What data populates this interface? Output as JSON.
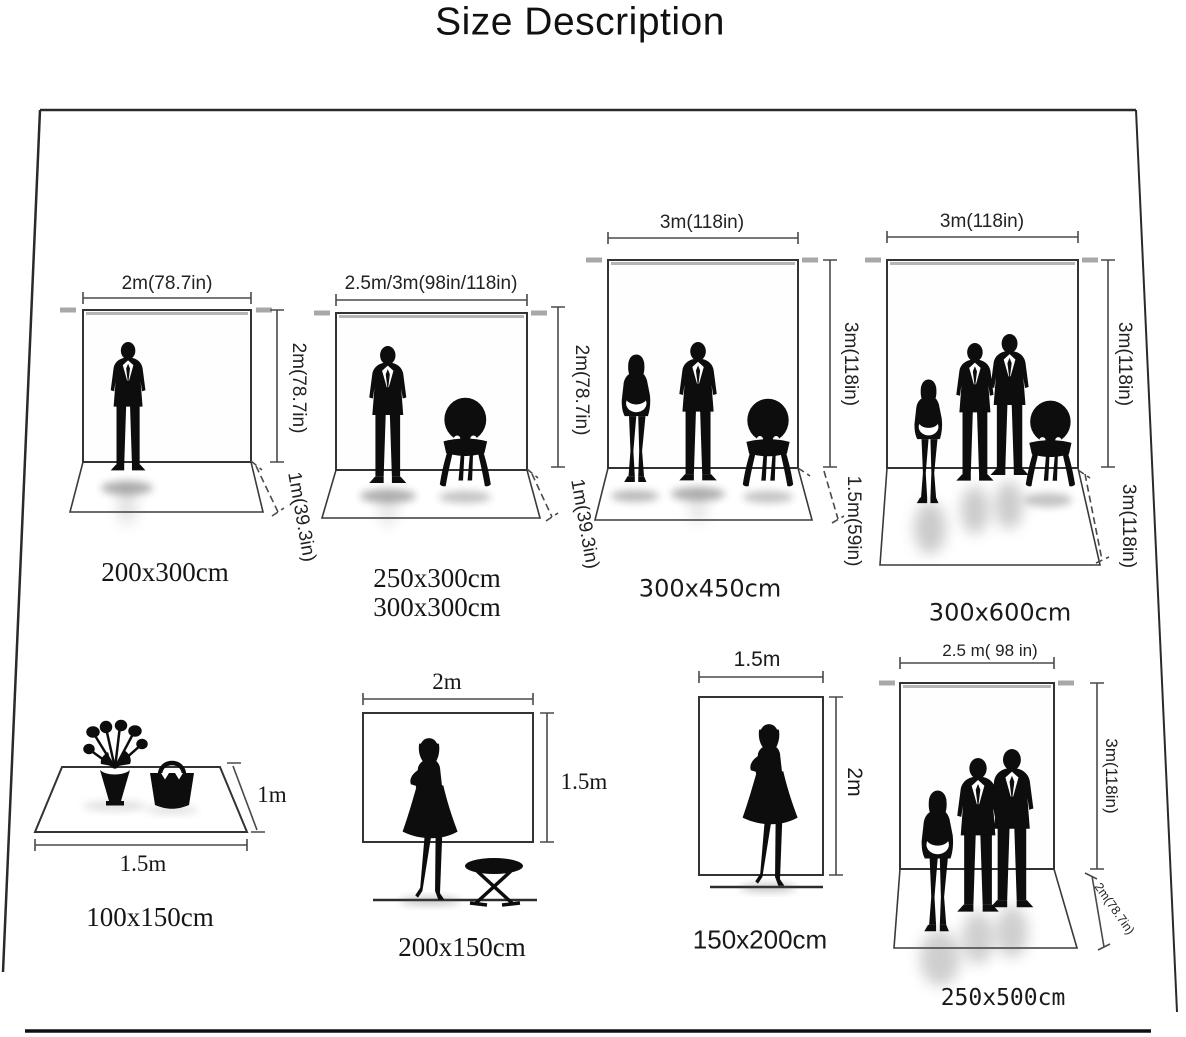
{
  "title": "Size Description",
  "panels": {
    "p1": {
      "width": "2m(78.7in)",
      "height": "2m(78.7in)",
      "floor": "1m(39.3in)",
      "size": "200x300cm"
    },
    "p2": {
      "width": "2.5m/3m(98in/118in)",
      "height": "2m(78.7in)",
      "floor": "1m(39.3in)",
      "size1": "250x300cm",
      "size2": "300x300cm"
    },
    "p3": {
      "width": "3m(118in)",
      "height": "3m(118in)",
      "floor": "1.5m(59in)",
      "size": "300x450cm"
    },
    "p4": {
      "width": "3m(118in)",
      "height": "3m(118in)",
      "floor": "3m(118in)",
      "size": "300x600cm"
    },
    "p5": {
      "width": "1.5m",
      "height": "1m",
      "size": "100x150cm"
    },
    "p6": {
      "width": "2m",
      "height": "1.5m",
      "size": "200x150cm"
    },
    "p7": {
      "width": "1.5m",
      "height": "2m",
      "size": "150x200cm"
    },
    "p8": {
      "width": "2.5 m( 98 in)",
      "height": "3m(118in)",
      "floor": "2m(78.7in)",
      "size": "250x500cm"
    }
  },
  "colors": {
    "ink": "#111111",
    "line": "#3a3a3a",
    "dim": "#4a4a4a",
    "pole": "#a8a8a8"
  }
}
